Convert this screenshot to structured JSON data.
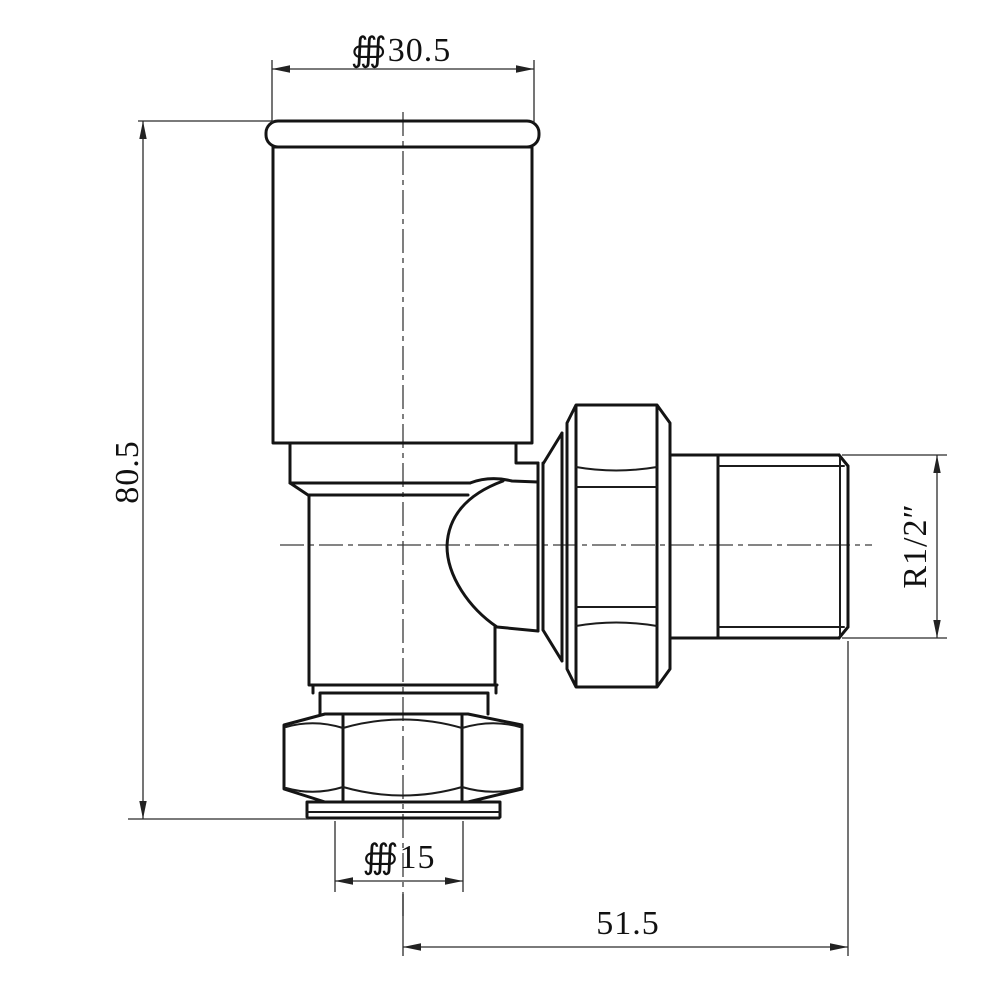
{
  "drawing": {
    "background": "#ffffff",
    "line_color": "#141414",
    "dimension_line_color": "#2b2b2b",
    "text_color": "#111111",
    "dimensions": {
      "head_diameter": "∰30.5",
      "overall_height": "80.5",
      "outlet_thread_size": "R1/2″",
      "inlet_diameter": "∰15",
      "outlet_length": "51.5"
    }
  }
}
